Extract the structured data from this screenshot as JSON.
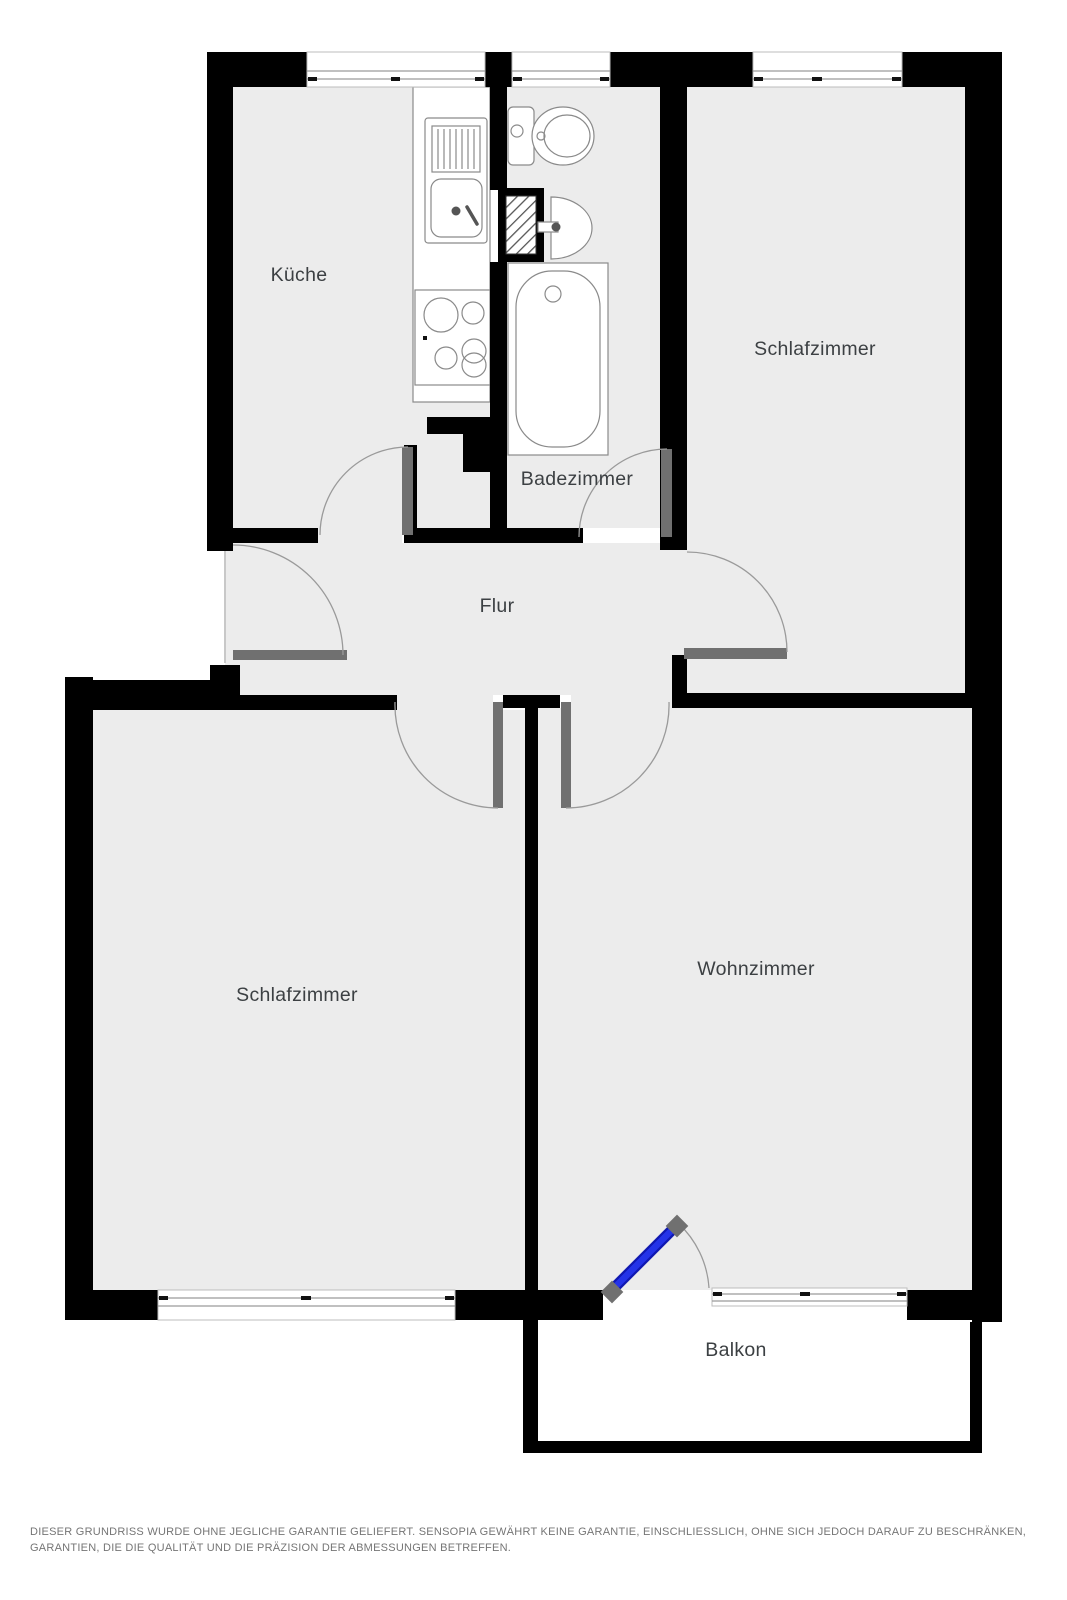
{
  "floorplan": {
    "rooms": [
      {
        "id": "kueche",
        "label": "Küche"
      },
      {
        "id": "badezimmer",
        "label": "Badezimmer"
      },
      {
        "id": "schlafzimmer_oben",
        "label": "Schlafzimmer"
      },
      {
        "id": "flur",
        "label": "Flur"
      },
      {
        "id": "schlafzimmer_unten",
        "label": "Schlafzimmer"
      },
      {
        "id": "wohnzimmer",
        "label": "Wohnzimmer"
      },
      {
        "id": "balkon",
        "label": "Balkon"
      }
    ],
    "fixtures": [
      "kitchen-sink",
      "stove",
      "toilet",
      "washbasin",
      "bathtub",
      "ventilation-shaft"
    ]
  },
  "disclaimer": {
    "text": "DIESER GRUNDRISS WURDE OHNE JEGLICHE GARANTIE GELIEFERT. SENSOPIA GEWÄHRT KEINE GARANTIE, EINSCHLIESSLICH, OHNE SICH JEDOCH DARAUF ZU BESCHRÄNKEN, GARANTIEN, DIE DIE QUALITÄT UND DIE PRÄZISION DER ABMESSUNGEN BETREFFEN."
  },
  "colors": {
    "wall": "#000000",
    "floor": "#ececec",
    "balcony_floor": "#ffffff",
    "door": "#707070",
    "balcony_door_core": "#2433e8",
    "balcony_door_edge": "#1018b0",
    "label_text": "#3c4043",
    "disclaimer_text": "#757575",
    "outline": "#8a8a8a",
    "arc": "#9a9a9a"
  }
}
